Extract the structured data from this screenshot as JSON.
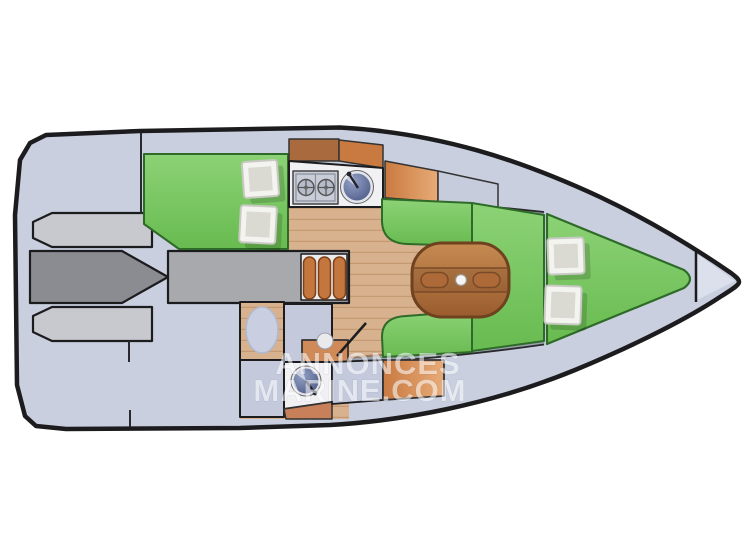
{
  "image": {
    "kind": "sailboat-interior-floorplan-top-view",
    "width": 747,
    "height": 560
  },
  "watermark": {
    "line1": "ANNONCES",
    "line2": "MARINE.COM"
  },
  "fixtures": [
    "two-burner-stove",
    "galley-round-sink",
    "folding-saloon-table",
    "toilet",
    "washbasin",
    "companionway-steps",
    "berth-pillows"
  ],
  "areas": [
    "cockpit",
    "companionway",
    "aft-cabin-berth",
    "galley",
    "saloon",
    "head",
    "v-berth",
    "bow-platform"
  ],
  "palette": {
    "background": "#ffffff",
    "hull_outline": "#1c1c1e",
    "deck": "#c9cfdf",
    "cockpit_bench": "#c7c9cf",
    "cockpit_floor": "#8b8c92",
    "companionway": "#a8a9ad",
    "steps_bg": "#ececee",
    "step_orange": "#c4763f",
    "wood_floor": "#d8b28e",
    "wood_plank_line": "#c49a72",
    "upholstery_green_light": "#8cd276",
    "upholstery_green": "#68bb50",
    "upholstery_green_border": "#2f6b28",
    "cabinet_brown": "#a96a3e",
    "cabinet_orange": "#c97a40",
    "cabinet_orange_light": "#e8ab77",
    "light_cabinet": "#c6ccdc",
    "cabin_locker_gray": "#c4cadc",
    "counter_white": "#f1f1f4",
    "fixture_steel": "#c9cdd8",
    "sink_steel_light": "#93a0c4",
    "sink_blue": "#4a5784",
    "table_wood_light": "#c68a52",
    "table_wood_dark": "#9a5c2e",
    "table_border": "#6e421f",
    "pillow_white": "#f3f3f0",
    "pillow_inner": "#dbdad2",
    "gunwale_gray": "#98a0ad",
    "gunwale_brown": "#9b7a5e",
    "toilet_blue": "#c9cfe0",
    "bow_tip": "#dbe0ec",
    "watermark_white": "#ffffff"
  }
}
